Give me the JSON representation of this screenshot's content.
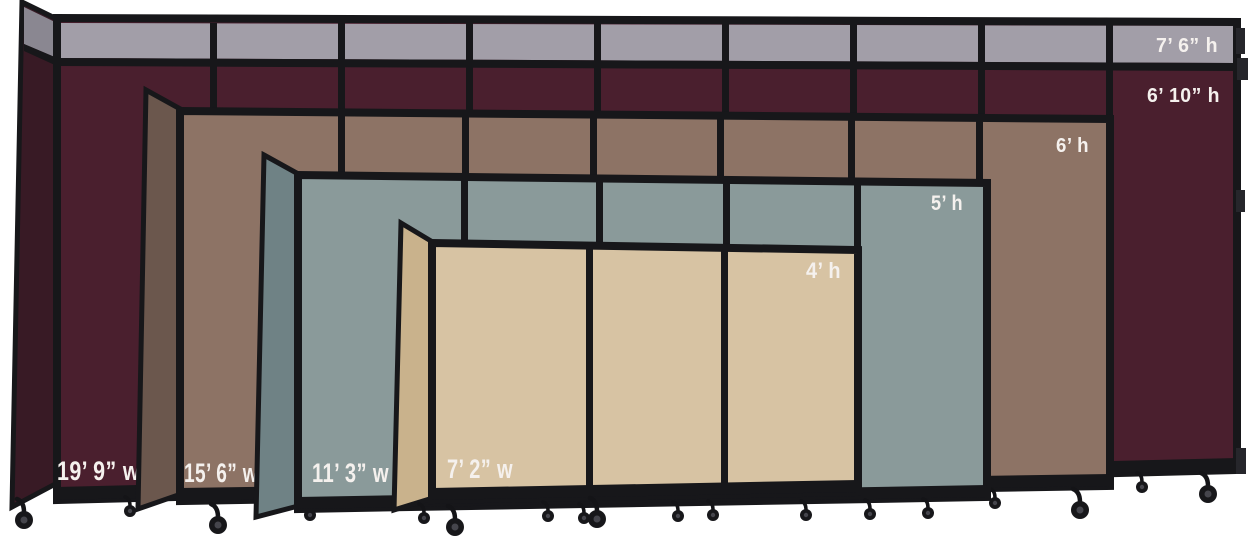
{
  "figure": {
    "subject": "Portable accordion room dividers nested size comparison",
    "background_color": "#ffffff",
    "frame_color": "#17171a",
    "label_text_color": "#f5f1ee",
    "dividers": [
      {
        "name": "divider-7ft6-cranberry",
        "colors": {
          "face": "#4a1f2e",
          "fold": "#381a25",
          "top_strip": "#a29ea8",
          "fold_top_strip": "#8a8791"
        },
        "height_labels": [
          "7’ 6” h",
          "6’ 10” h"
        ],
        "width_label": "19’ 9” w"
      },
      {
        "name": "divider-6ft-brown",
        "colors": {
          "face": "#8d7365",
          "fold": "#6b574d"
        },
        "height_labels": [
          "6’ h"
        ],
        "width_label": "15’ 6” w"
      },
      {
        "name": "divider-5ft-slate",
        "colors": {
          "face": "#8a9a9a",
          "fold": "#6f8285"
        },
        "height_labels": [
          "5’ h"
        ],
        "width_label": "11’ 3” w"
      },
      {
        "name": "divider-4ft-sand",
        "colors": {
          "face": "#d7c3a3",
          "fold": "#c9b28c"
        },
        "height_labels": [
          "4’ h"
        ],
        "width_label": "7’ 2” w"
      }
    ]
  }
}
